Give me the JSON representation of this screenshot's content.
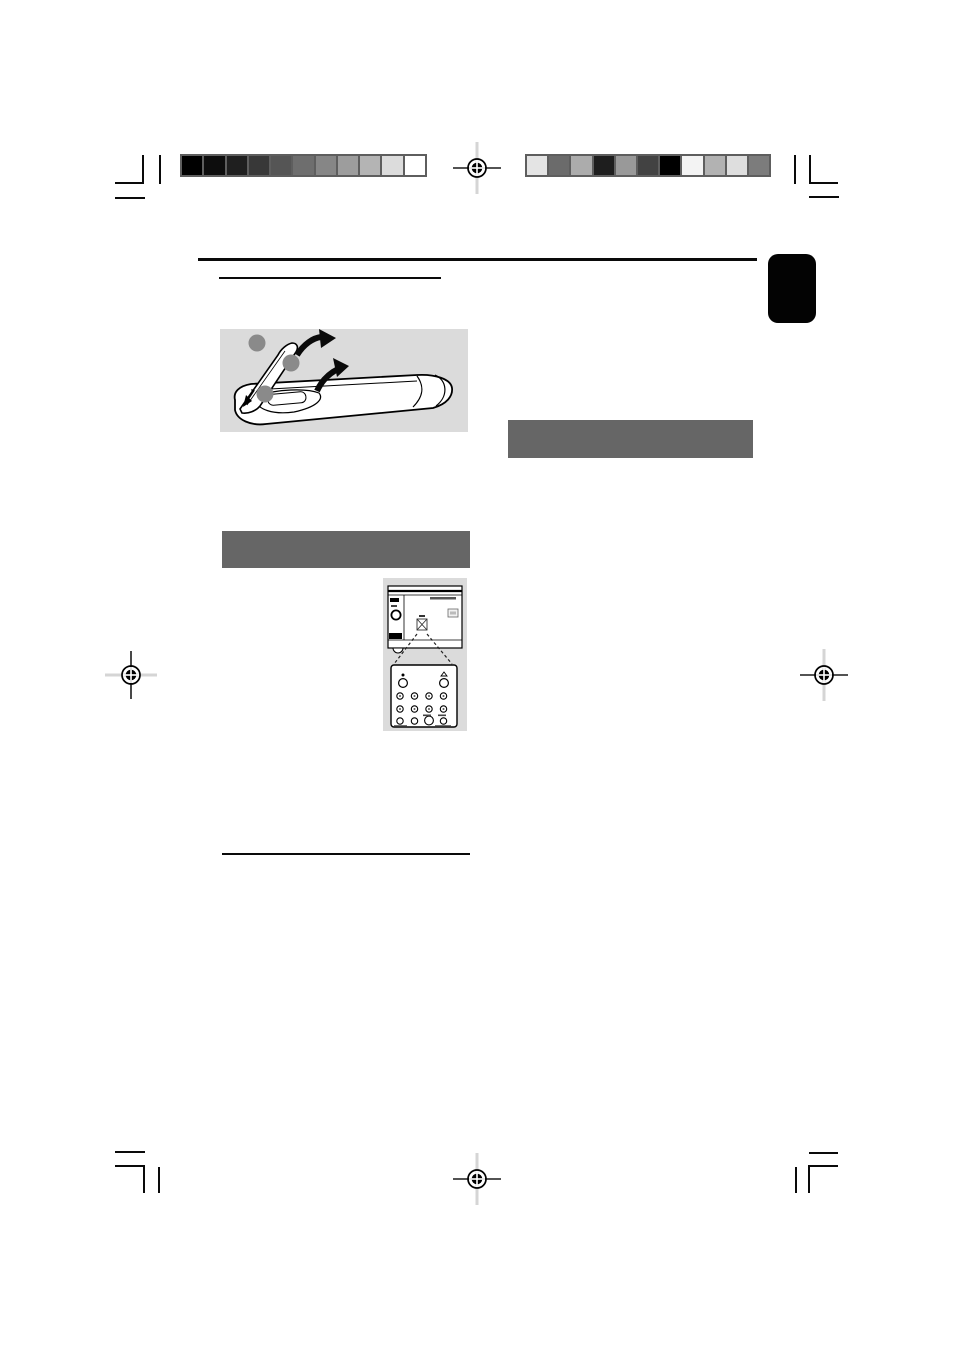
{
  "colors": {
    "page_background": "#ffffff",
    "crop_mark": "#0a0a0a",
    "rule": "#0a0a0a",
    "section_header_bar": "#666666",
    "illustration_background": "#dbdbdb",
    "page_tab": "#030303",
    "registration_light_line": "#d5d5d5",
    "callout_dot": "#8a8a8a"
  },
  "print_marks": {
    "calibration_bar_left": {
      "swatches": [
        "#000000",
        "#0d0d0d",
        "#1f1f1f",
        "#383838",
        "#555555",
        "#6e6e6e",
        "#868686",
        "#9d9d9d",
        "#b4b4b4",
        "#dcdcdc",
        "#ffffff"
      ]
    },
    "calibration_bar_right": {
      "swatches": [
        "#e4e4e4",
        "#6b6b6b",
        "#acacac",
        "#1e1e1e",
        "#999999",
        "#424242",
        "#000000",
        "#f3f3f3",
        "#b2b2b2",
        "#dedede",
        "#7c7c7c"
      ]
    },
    "registration_marks": [
      {
        "position": "top-center"
      },
      {
        "position": "left-middle"
      },
      {
        "position": "right-middle"
      },
      {
        "position": "bottom-center"
      }
    ],
    "crop_mark_corners": [
      "top-left",
      "top-right",
      "bottom-left",
      "bottom-right"
    ]
  },
  "content": {
    "left_column": {
      "heading_underline_rules": 2,
      "section_header_bars": 1,
      "figures": [
        {
          "name": "battery-installation",
          "callout_dots": 3
        },
        {
          "name": "ir-sensor-and-remote"
        }
      ]
    },
    "right_column": {
      "section_header_bars": 1
    },
    "page_edge_tab": {
      "side": "right",
      "shape": "rounded-rectangle"
    }
  }
}
